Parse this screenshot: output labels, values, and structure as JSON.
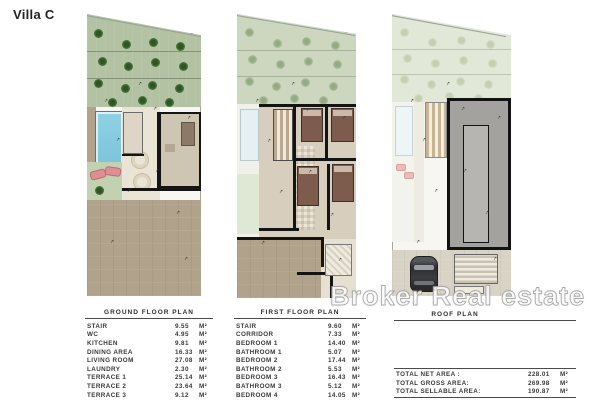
{
  "title": "Villa C",
  "watermark": "Broker Real estate",
  "decor": {
    "marker_glyph": "↗",
    "tree_icon": "tree",
    "car_icon": "car-top-view"
  },
  "colors": {
    "garden_ground": "#b3c2a3",
    "garden_first": "#cdd7c0",
    "garden_roof": "#e2e8d7",
    "pool_blue": "#8fd2e4",
    "driveway_tan": "#b1a28b",
    "wall_black": "#141414",
    "roof_gray": "#a4a29f",
    "watermark_white": "#ffffff"
  },
  "tables": {
    "ground": {
      "title": "GROUND FLOOR PLAN",
      "unit": "M²",
      "rows": [
        [
          "STAIR",
          "9.55"
        ],
        [
          "WC",
          "4.95"
        ],
        [
          "KITCHEN",
          "9.81"
        ],
        [
          "DINING AREA",
          "16.33"
        ],
        [
          "LIVING ROOM",
          "27.08"
        ],
        [
          "LAUNDRY",
          "2.30"
        ],
        [
          "TERRACE 1",
          "25.14"
        ],
        [
          "TERRACE 2",
          "23.64"
        ],
        [
          "TERRACE 3",
          "9.12"
        ]
      ]
    },
    "first": {
      "title": "FIRST FLOOR PLAN",
      "unit": "M²",
      "rows": [
        [
          "STAIR",
          "9.60"
        ],
        [
          "CORRIDOR",
          "7.33"
        ],
        [
          "BEDROOM 1",
          "14.40"
        ],
        [
          "BATHROOM 1",
          "5.07"
        ],
        [
          "BEDROOM 2",
          "17.44"
        ],
        [
          "BATHROOM 2",
          "5.53"
        ],
        [
          "BEDROOM 3",
          "16.43"
        ],
        [
          "BATHROOM 3",
          "5.12"
        ],
        [
          "BEDROOM 4",
          "14.05"
        ],
        [
          "BATHROOM 4",
          "5.12"
        ]
      ]
    },
    "roof": {
      "title": "ROOF PLAN",
      "unit": "M²",
      "rows": [
        [
          "TOTAL NET AREA :",
          "228.01"
        ],
        [
          "TOTAL GROSS AREA:",
          "269.98"
        ],
        [
          "TOTAL SELLABLE AREA:",
          "190.87"
        ]
      ]
    }
  }
}
